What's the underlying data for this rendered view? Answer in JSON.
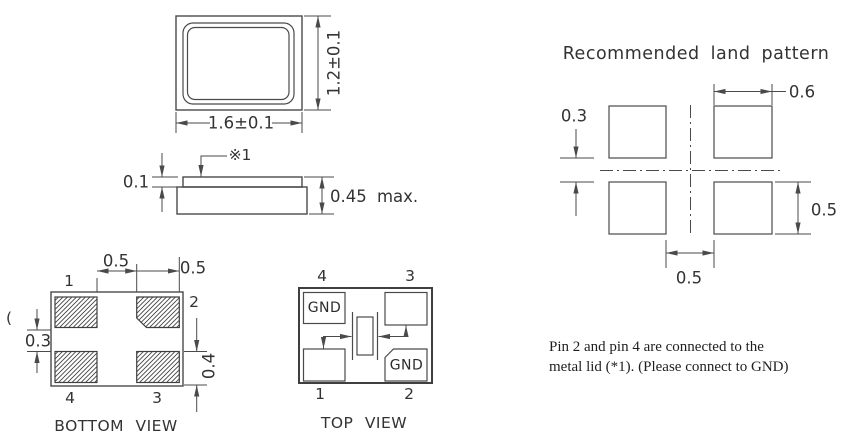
{
  "drawing": {
    "package_outline": {
      "width_dim": "1.6±0.1",
      "height_dim": "1.2±0.1"
    },
    "side_view": {
      "lid_ref_mark": "※1",
      "lid_thickness_dim": "0.1",
      "max_height_dim": "0.45 max."
    },
    "bottom_view": {
      "title": "BOTTOM VIEW",
      "pin1": "1",
      "pin2": "2",
      "pin3": "3",
      "pin4": "4",
      "pad_gap_h_dim": "0.5",
      "pad_width_dim": "0.5",
      "pad_gap_v_dim": "0.3",
      "pad_height_dim": "0.4",
      "stray_mark": "("
    },
    "top_view": {
      "title": "TOP VIEW",
      "pin1": "1",
      "pin2": "2",
      "pin3": "3",
      "pin4": "4",
      "pad2_label": "GND",
      "pad4_label": "GND"
    },
    "land_pattern": {
      "title": "Recommended land pattern",
      "pad_width_dim": "0.6",
      "pad_gap_v_dim": "0.3",
      "pad_height_dim": "0.5",
      "pad_gap_h_dim": "0.5"
    },
    "note": {
      "line1": "Pin 2 and pin 4 are connected to the",
      "line2": "metal lid (*1). (Please connect to GND)"
    },
    "colors": {
      "line": "#4a4a4a",
      "text": "#333333",
      "note_text": "#1f1f1f",
      "background": "#ffffff"
    }
  }
}
